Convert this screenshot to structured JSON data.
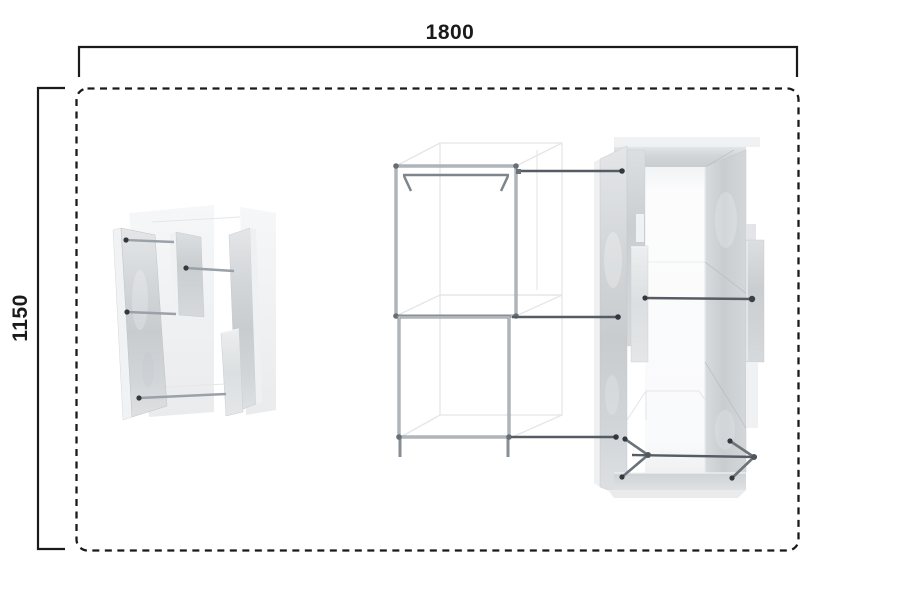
{
  "drawing": {
    "kind": "furniture-plan-top-view",
    "dimensions": {
      "width": {
        "label": "1800"
      },
      "height": {
        "label": "1150"
      }
    },
    "boundary": {
      "style": "dashed-rounded-rectangle"
    },
    "items": [
      {
        "id": "corner-panel-unit"
      },
      {
        "id": "clothes-rack-frame"
      },
      {
        "id": "wardrobe-unit"
      }
    ]
  },
  "colors": {
    "bg": "#ffffff",
    "line-color": "#1a1a1a",
    "ghost-line": "#e4e6e8",
    "metal-tube": "#878e95",
    "metal-rod": "#565c63",
    "rod-cap": "#33383d",
    "panel-mid": "#ccd0d3",
    "panel-light": "#eceeef",
    "panel-edge": "#f1f2f3"
  }
}
